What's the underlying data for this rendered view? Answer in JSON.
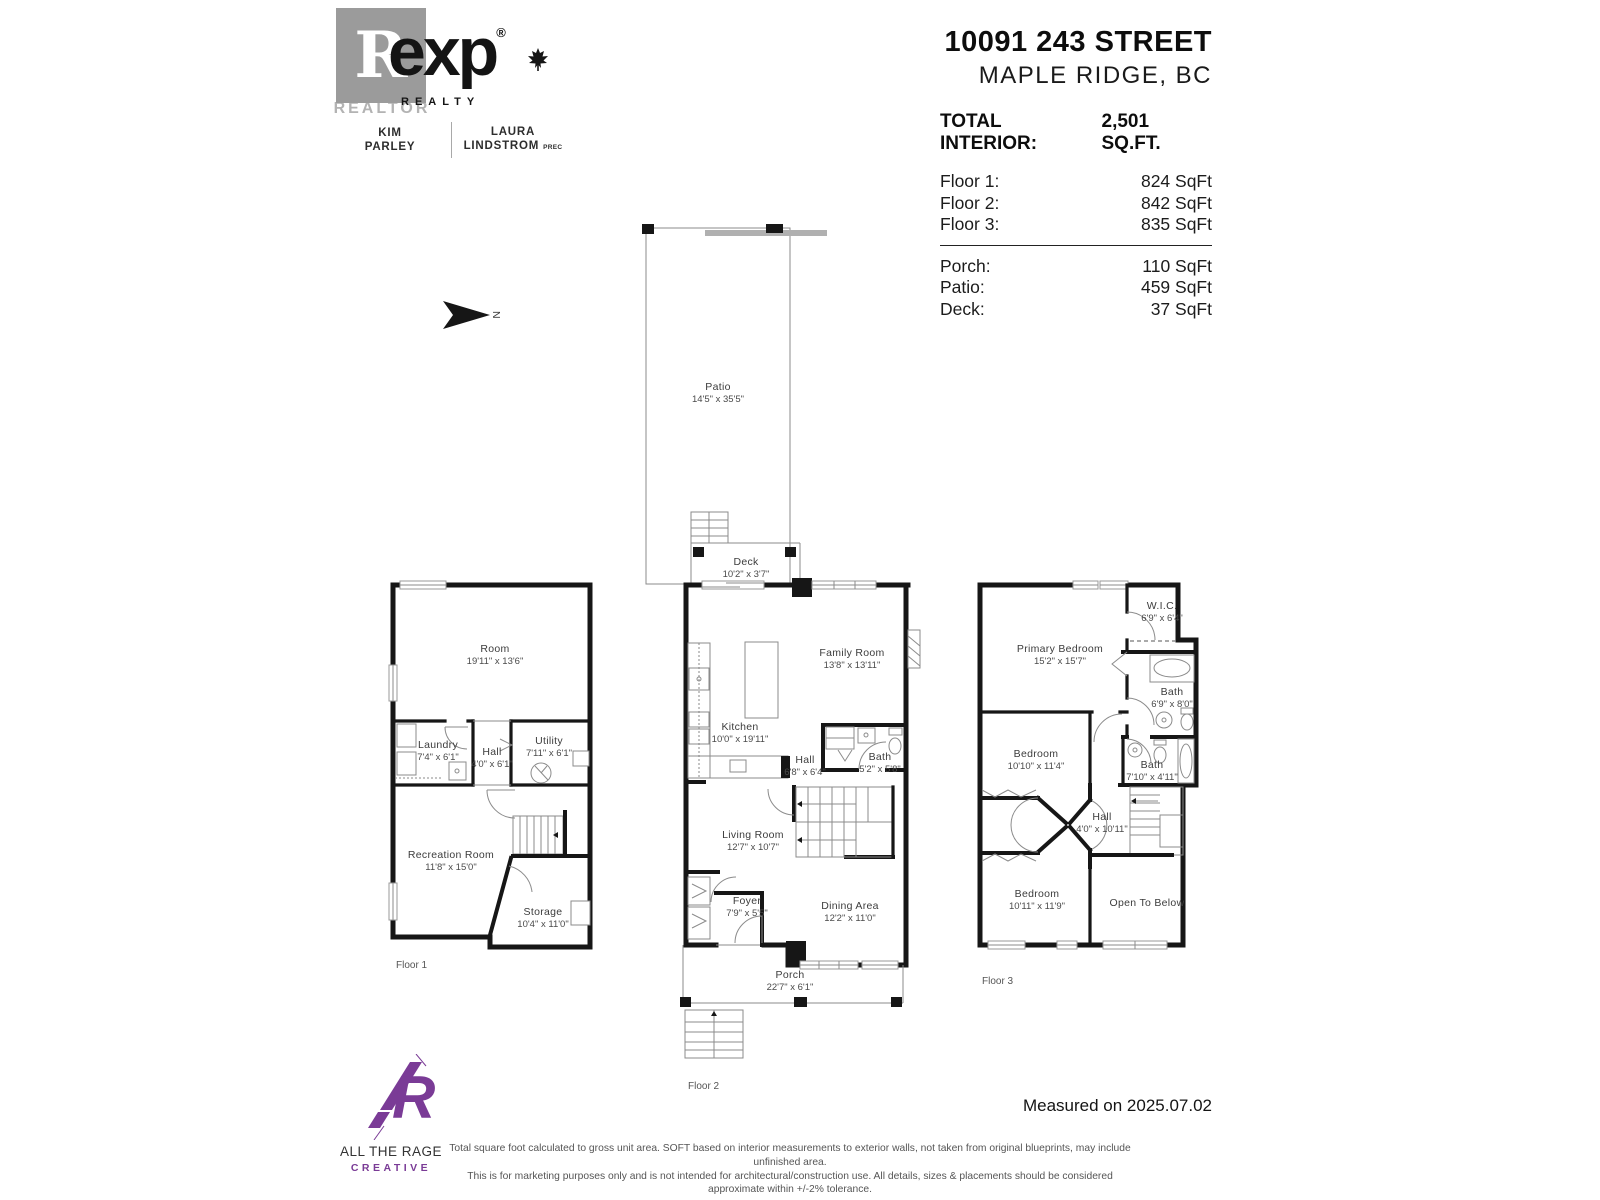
{
  "branding": {
    "realtor_glyph": "R",
    "realtor_word": "REALTOR",
    "exp_name": "exp",
    "reg_mark": "®",
    "exp_sub": "REALTY",
    "agent1_line1": "KIM",
    "agent1_line2": "PARLEY",
    "agent2_line1": "LAURA",
    "agent2_line2": "LINDSTROM",
    "agent2_suffix": "PREC"
  },
  "header": {
    "address_line1": "10091 243 STREET",
    "address_line2": "MAPLE RIDGE, BC",
    "total_label": "TOTAL INTERIOR:",
    "total_value": "2,501 SQ.FT.",
    "floor_areas": [
      {
        "label": "Floor 1:",
        "value": "824 SqFt"
      },
      {
        "label": "Floor 2:",
        "value": "842 SqFt"
      },
      {
        "label": "Floor 3:",
        "value": "835 SqFt"
      }
    ],
    "outdoor_areas": [
      {
        "label": "Porch:",
        "value": "110 SqFt"
      },
      {
        "label": "Patio:",
        "value": "459 SqFt"
      },
      {
        "label": "Deck:",
        "value": "37 SqFt"
      }
    ]
  },
  "compass_letter": "N",
  "floor1": {
    "label": "Floor 1",
    "rooms": {
      "room": {
        "name": "Room",
        "dims": "19'11\" x 13'6\""
      },
      "laundry": {
        "name": "Laundry",
        "dims": "7'4\" x 6'1\""
      },
      "hall": {
        "name": "Hall",
        "dims": "4'0\" x 6'1\""
      },
      "utility": {
        "name": "Utility",
        "dims": "7'11\" x 6'1\""
      },
      "recreation": {
        "name": "Recreation Room",
        "dims": "11'8\" x 15'0\""
      },
      "storage": {
        "name": "Storage",
        "dims": "10'4\" x 11'0\""
      }
    }
  },
  "floor2": {
    "label": "Floor 2",
    "rooms": {
      "patio": {
        "name": "Patio",
        "dims": "14'5\" x 35'5\""
      },
      "deck": {
        "name": "Deck",
        "dims": "10'2\" x 3'7\""
      },
      "family": {
        "name": "Family Room",
        "dims": "13'8\" x 13'11\""
      },
      "kitchen": {
        "name": "Kitchen",
        "dims": "10'0\" x 19'11\""
      },
      "hall": {
        "name": "Hall",
        "dims": "6'8\" x 6'4\""
      },
      "bath": {
        "name": "Bath",
        "dims": "5'2\" x 5'8\""
      },
      "living": {
        "name": "Living Room",
        "dims": "12'7\" x 10'7\""
      },
      "foyer": {
        "name": "Foyer",
        "dims": "7'9\" x 5'5\""
      },
      "dining": {
        "name": "Dining Area",
        "dims": "12'2\" x 11'0\""
      },
      "porch": {
        "name": "Porch",
        "dims": "22'7\" x 6'1\""
      }
    }
  },
  "floor3": {
    "label": "Floor 3",
    "rooms": {
      "primary": {
        "name": "Primary Bedroom",
        "dims": "15'2\" x 15'7\""
      },
      "wic": {
        "name": "W.I.C.",
        "dims": "6'9\" x 6'4\""
      },
      "bath1": {
        "name": "Bath",
        "dims": "6'9\" x 8'0\""
      },
      "bath2": {
        "name": "Bath",
        "dims": "7'10\" x 4'11\""
      },
      "bedroom_mid": {
        "name": "Bedroom",
        "dims": "10'10\" x 11'4\""
      },
      "hall": {
        "name": "Hall",
        "dims": "4'0\" x 10'11\""
      },
      "bedroom_bottom": {
        "name": "Bedroom",
        "dims": "10'11\" x 11'9\""
      },
      "open": {
        "name": "Open To Below",
        "dims": ""
      }
    }
  },
  "footer": {
    "studio_line1": "ALL THE RAGE",
    "studio_line2": "CREATIVE",
    "measured": "Measured on 2025.07.02",
    "disclaimer_line1": "Total square foot calculated to gross unit area. SOFT based on interior measurements to exterior walls, not taken from original blueprints, may include unfinished area.",
    "disclaimer_line2": "This is for marketing purposes only and is not intended for architectural/construction use. All details, sizes & placements should be considered approximate within +/-2% tolerance."
  },
  "colors": {
    "wall_black": "#161616",
    "accent_purple": "#7a3b96",
    "logo_gray": "#9b9b9b"
  }
}
